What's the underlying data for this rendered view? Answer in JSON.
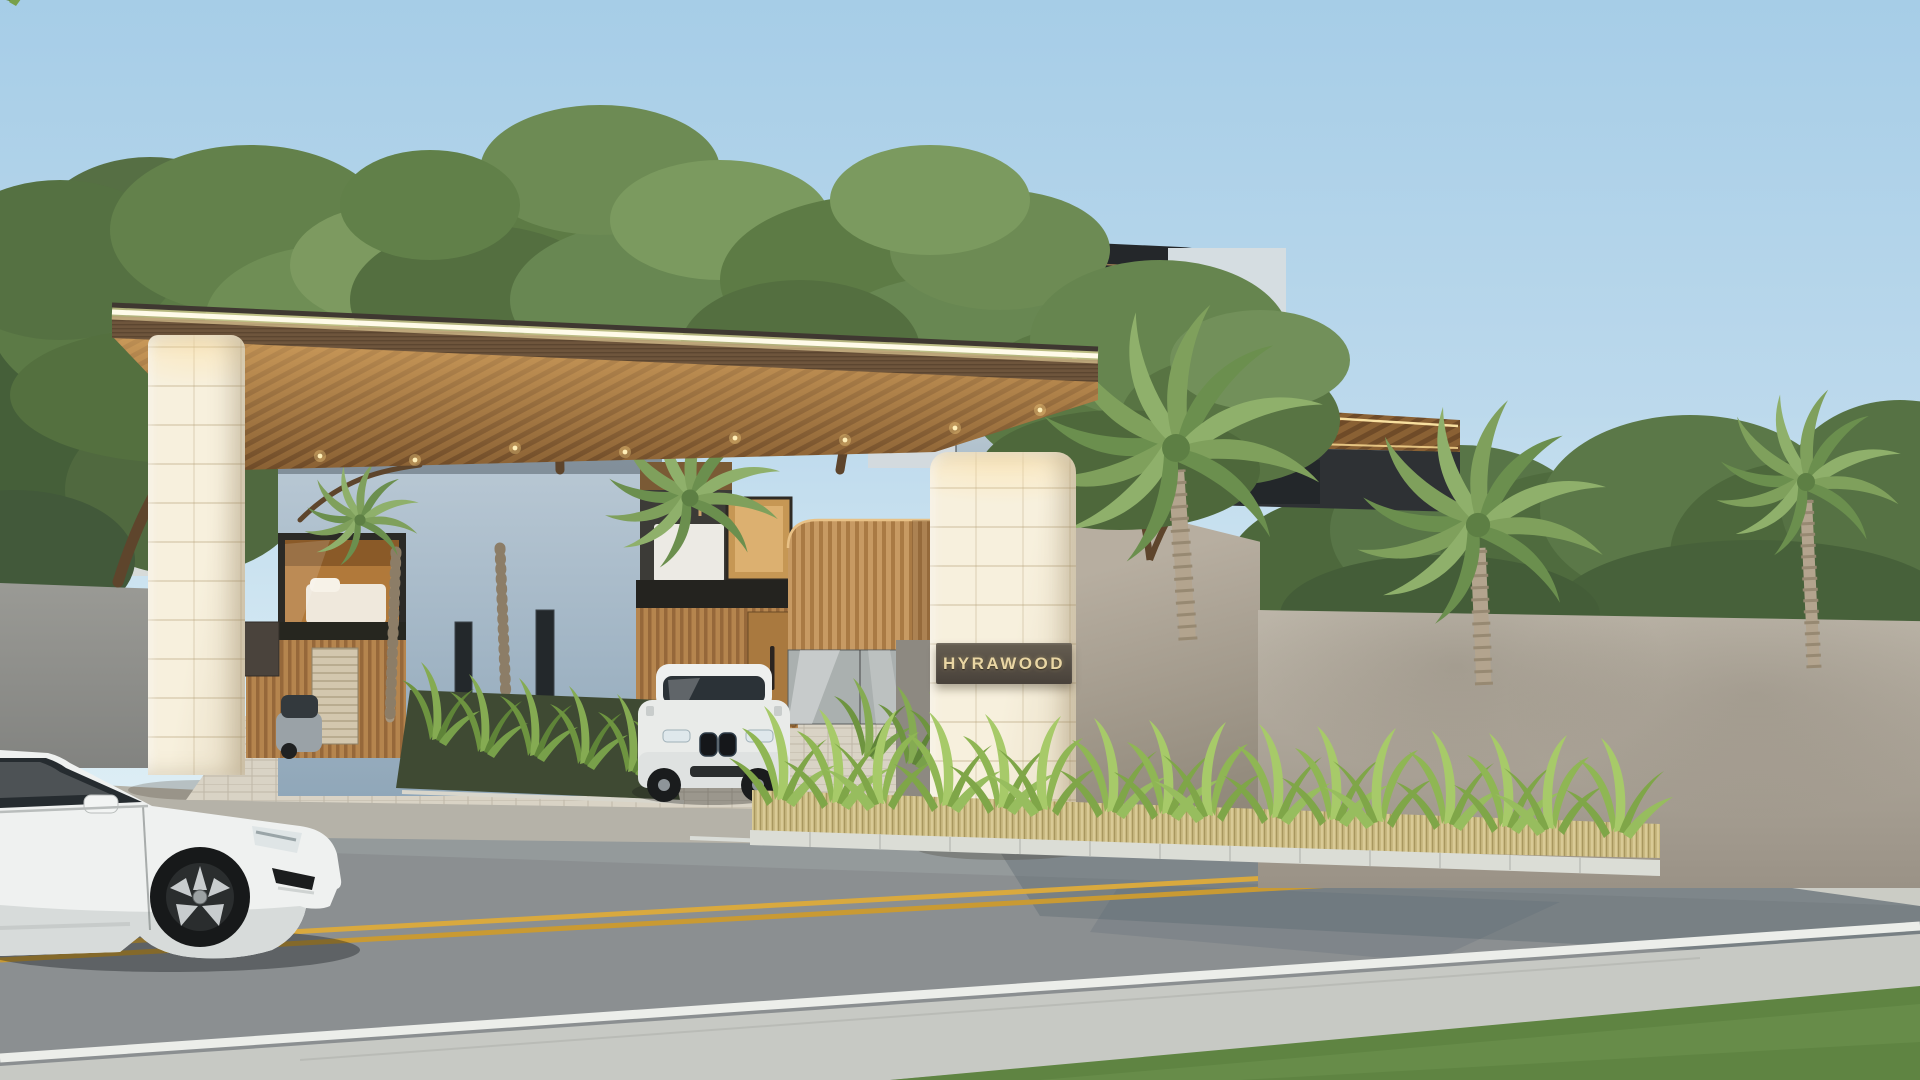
{
  "scene": {
    "title": "HYRAWOOD",
    "type": "architectural-exterior-render",
    "sign": {
      "text": "HYRAWOOD",
      "plaque_color": "#554e43",
      "letter_color": "#e9d6a4"
    },
    "palette": {
      "sky_top": "#a6cde7",
      "sky_horizon": "#ecf6f8",
      "stone_pillar": "#f2ead7",
      "canopy_wood": "#8a6134",
      "led_strip": "#fffbe9",
      "building_wall_blue": "#a7bac9",
      "roof_dark": "#26292c",
      "wood_slat": "#c0905a",
      "tree_foliage": "#5d7b45",
      "palm_frond": "#7fa05c",
      "hedge_leaf": "#a7ca69",
      "dry_grass": "#c9b981",
      "perimeter_wall": "#a49c8f",
      "road_asphalt": "#8b8f91",
      "lane_yellow": "#d8a83c",
      "line_white": "#eceeea",
      "sidewalk": "#c7c9c4",
      "lawn_grass": "#5f8442",
      "car_white": "#eff1f0",
      "suv_white": "#e9ebe9",
      "glass_dark": "#2b3237"
    },
    "objects": [
      "sky",
      "background-trees",
      "neighbor-houses",
      "rooftop-water-tanks",
      "villa-curved-roofs",
      "balcony-planters",
      "arched-window",
      "entrance-canopy",
      "gate-pillar-left",
      "gate-pillar-right",
      "project-sign",
      "wood-slat-kiosk",
      "glass-booth",
      "driveway",
      "bmw-suv",
      "gray-car",
      "interior-bedroom",
      "garage-wood-wall",
      "perimeter-wall",
      "palm-trees",
      "hedge-planter",
      "dry-grass-bed",
      "curb",
      "road",
      "double-yellow-line",
      "white-edge-line",
      "sidewalk",
      "lawn",
      "white-sedan"
    ]
  }
}
